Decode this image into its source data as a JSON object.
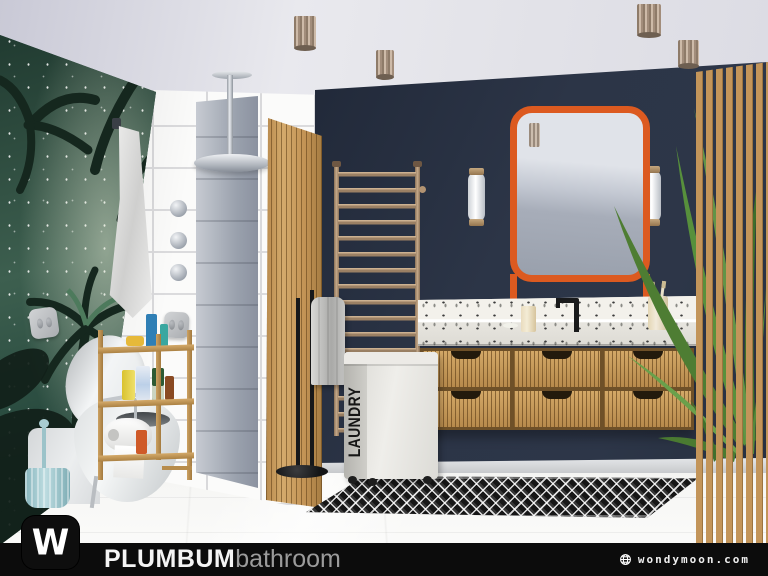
{
  "branding": {
    "logo_monogram": "W",
    "title": "PLUMBUM",
    "subtitle": "bathroom",
    "website": "wondymoon.com"
  },
  "labels": {
    "laundry_basket": "LAUNDRY"
  },
  "colors": {
    "accent_orange": "#DC5A20",
    "navy_wall": "#2C3547",
    "wood": "#C3955A",
    "brass": "#B29372",
    "mural_green": "#2C4A3D",
    "footer_bg": "#0C0C0C",
    "rug_black": "#161616",
    "floor_white": "#F4F4F2",
    "ceiling_gray": "#DEDEE6",
    "tile_white": "#FBFBFA",
    "towel_gray": "#BDBDBB",
    "toilet_white": "#E9EBEC",
    "brush_blue": "#9CC3C9"
  }
}
